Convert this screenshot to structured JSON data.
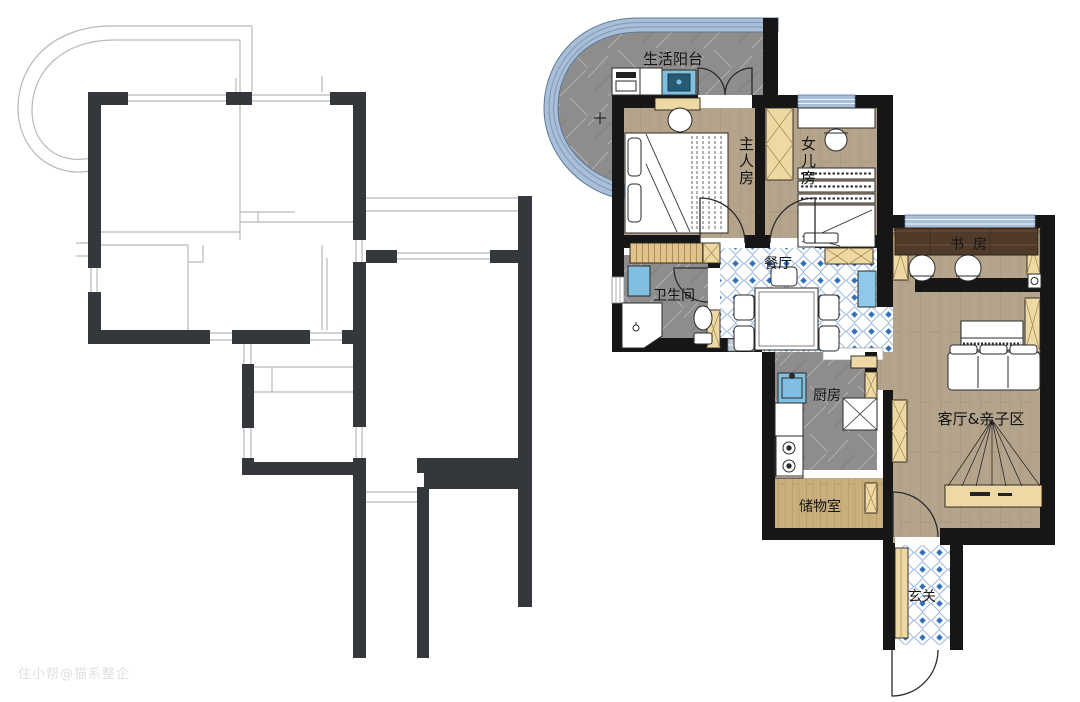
{
  "watermark": {
    "text": "住小帮@猫系整企"
  },
  "right_plan": {
    "rooms": [
      {
        "id": "balcony",
        "label": "生活阳台"
      },
      {
        "id": "master-bedroom",
        "label": "主人房"
      },
      {
        "id": "daughter-room",
        "label": "女儿房"
      },
      {
        "id": "study",
        "label": "书房"
      },
      {
        "id": "dining",
        "label": "餐厅"
      },
      {
        "id": "bathroom",
        "label": "卫生间"
      },
      {
        "id": "kitchen",
        "label": "厨房"
      },
      {
        "id": "living",
        "label": "客厅&亲子区"
      },
      {
        "id": "storage",
        "label": "储物室"
      },
      {
        "id": "foyer",
        "label": "玄关"
      }
    ],
    "palette": {
      "wall": "#161616",
      "wood_floor": "#b5a48c",
      "dark_desk_wood": "#503b2a",
      "marble_gray": "#8f8d8c",
      "tile_blue": "#2e6fbe",
      "tile_line_blue": "#9db9dd",
      "window_band_blue": "#a9bed7",
      "wardrobe_tan": "#eed9a4",
      "storage_wood": "#c9ae7e",
      "appliance_blue": "#7fc0e2",
      "cabinet_blue": "#8fc8e8"
    }
  },
  "left_plan": {
    "palette": {
      "wall": "#34383c",
      "outline": "#b9b9b9"
    }
  }
}
